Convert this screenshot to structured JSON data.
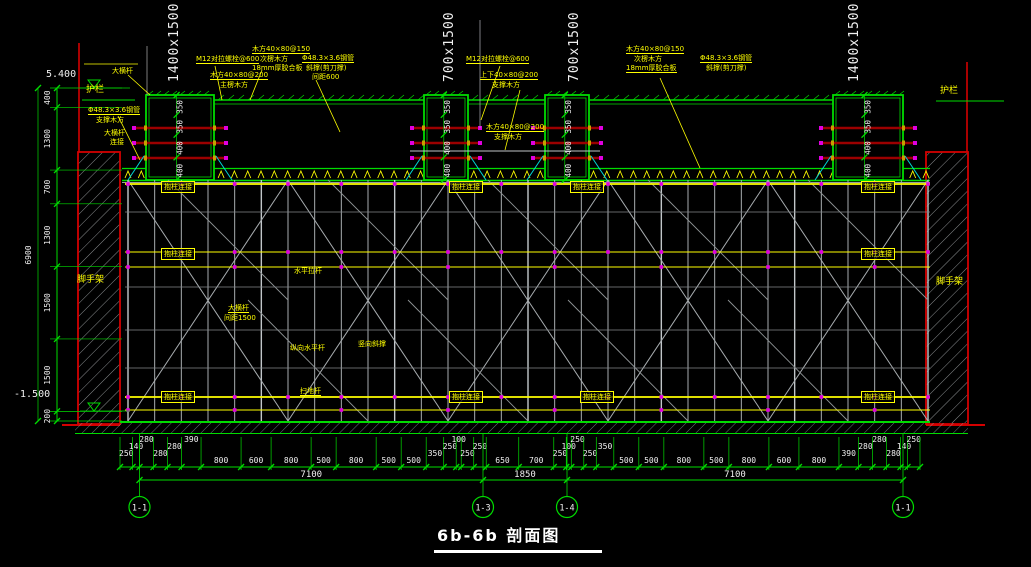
{
  "title": "6b-6b 剖面图",
  "levels": {
    "top": "5.400",
    "bottom": "-1.500"
  },
  "left_dim_chain": {
    "values": [
      "400",
      "1300",
      "700",
      "1300",
      "1500",
      "1500",
      "200"
    ],
    "total": "6900"
  },
  "beams": [
    {
      "size_label": "1400x1500",
      "dims": [
        "350",
        "350",
        "400",
        "400"
      ]
    },
    {
      "size_label": "700x1500",
      "dims": [
        "350",
        "350",
        "400",
        "400"
      ]
    },
    {
      "size_label": "700x1500",
      "dims": [
        "350",
        "350",
        "400",
        "400"
      ]
    },
    {
      "size_label": "1400x1500",
      "dims": [
        "350",
        "350",
        "400",
        "400"
      ]
    }
  ],
  "bottom_dim_chain": {
    "values": [
      "250",
      "140",
      "280",
      "280",
      "280",
      "390",
      "800",
      "600",
      "800",
      "500",
      "800",
      "500",
      "500",
      "350",
      "250",
      "100",
      "250",
      "250",
      "650",
      "700",
      "250",
      "100",
      "250",
      "250",
      "350",
      "500",
      "500",
      "800",
      "500",
      "800",
      "600",
      "800",
      "390",
      "280",
      "280",
      "280",
      "140",
      "250"
    ],
    "totals": [
      "7100",
      "1850",
      "7100"
    ]
  },
  "axes": [
    "1-1",
    "1-3",
    "1-4",
    "1-1"
  ],
  "labels": {
    "guardrail": "护栏",
    "scaffold_wall": "脚手架",
    "column_tie": "抱柱连接",
    "big_ledger": "大横杆",
    "ledger_spacing": "间距1500",
    "horizontal_tie": "水平拉杆",
    "sweep_rod": "扫地杆",
    "longitudinal_rod": "纵向水平杆",
    "vertical_brace": "竖向斜撑",
    "connect": "连接"
  },
  "annotations": {
    "tie_bolt": "M12对拉螺栓@600",
    "main_joist": "木方40×80@200",
    "main_joist_sub": "主楞木方",
    "sec_joist": "木方40×80@150",
    "sec_joist_sub": "次楞木方",
    "plywood": "18mm厚胶合板",
    "steel_pipe": "Φ48.3×3.6钢管",
    "diag_brace": "斜撑(剪刀撑)",
    "spacing": "间距600",
    "updown_joist": "上下40×80@200",
    "support_joist": "支撑木方"
  },
  "colors": {
    "green": "#00dc00",
    "red": "#d40000",
    "tie_red": "#9c0000",
    "yellow": "#ffff00",
    "white": "#f0f0f0",
    "gray": "#a8adb0",
    "magenta": "#e000e0",
    "cyan": "#00d8d8"
  }
}
